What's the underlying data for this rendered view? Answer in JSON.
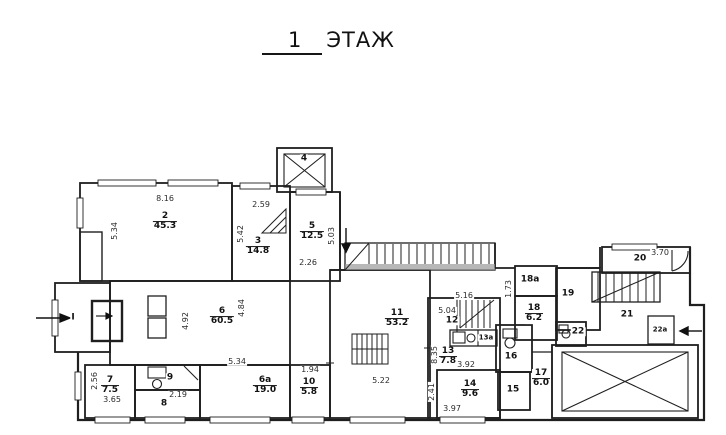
{
  "title": {
    "floor_number": "1",
    "floor_word": "ЭТАЖ"
  },
  "colors": {
    "background": "#ffffff",
    "line": "#1f1f1f",
    "dim_text": "#2b2b2b"
  },
  "plan": {
    "rooms": [
      {
        "num": "2",
        "area": "45.3",
        "x": 165,
        "y": 222
      },
      {
        "num": "3",
        "area": "14.8",
        "x": 258,
        "y": 247
      },
      {
        "num": "5",
        "area": "12.5",
        "x": 312,
        "y": 232
      },
      {
        "num": "6",
        "area": "60.5",
        "x": 222,
        "y": 317
      },
      {
        "num": "6а",
        "area": "19.0",
        "x": 265,
        "y": 386
      },
      {
        "num": "7",
        "area": "7.5",
        "x": 110,
        "y": 386
      },
      {
        "num": "10",
        "area": "5.8",
        "x": 309,
        "y": 388
      },
      {
        "num": "11",
        "area": "53.2",
        "x": 397,
        "y": 319
      },
      {
        "num": "13",
        "area": "7.8",
        "x": 448,
        "y": 357
      },
      {
        "num": "14",
        "area": "9.6",
        "x": 470,
        "y": 390
      },
      {
        "num": "17",
        "area": "6.0",
        "x": 541,
        "y": 379
      },
      {
        "num": "18",
        "area": "6.2",
        "x": 534,
        "y": 314
      }
    ],
    "labels": [
      {
        "text": "4",
        "x": 304,
        "y": 159
      },
      {
        "text": "8",
        "x": 164,
        "y": 404
      },
      {
        "text": "9",
        "x": 170,
        "y": 378
      },
      {
        "text": "12",
        "x": 452,
        "y": 321
      },
      {
        "text": "13а",
        "x": 486,
        "y": 338,
        "small": true
      },
      {
        "text": "15",
        "x": 513,
        "y": 390
      },
      {
        "text": "16",
        "x": 511,
        "y": 357
      },
      {
        "text": "19",
        "x": 568,
        "y": 294
      },
      {
        "text": "20",
        "x": 640,
        "y": 259
      },
      {
        "text": "21",
        "x": 627,
        "y": 315
      },
      {
        "text": "22",
        "x": 578,
        "y": 332
      },
      {
        "text": "22а",
        "x": 660,
        "y": 330,
        "small": true
      },
      {
        "text": "18а",
        "x": 530,
        "y": 280
      },
      {
        "text": "I",
        "x": 73,
        "y": 318
      }
    ],
    "dimensions": [
      {
        "text": "8.16",
        "x": 165,
        "y": 199
      },
      {
        "text": "2.59",
        "x": 261,
        "y": 205
      },
      {
        "text": "2.26",
        "x": 308,
        "y": 263
      },
      {
        "text": "5.34",
        "x": 115,
        "y": 231,
        "rot": 90
      },
      {
        "text": "5.42",
        "x": 241,
        "y": 234,
        "rot": 90
      },
      {
        "text": "5.03",
        "x": 332,
        "y": 236,
        "rot": 90
      },
      {
        "text": "4.92",
        "x": 186,
        "y": 321,
        "rot": 90
      },
      {
        "text": "4.84",
        "x": 242,
        "y": 308,
        "rot": 90
      },
      {
        "text": "5.34",
        "x": 237,
        "y": 362
      },
      {
        "text": "3.65",
        "x": 112,
        "y": 400
      },
      {
        "text": "2.56",
        "x": 95,
        "y": 381,
        "rot": 90
      },
      {
        "text": "2.19",
        "x": 178,
        "y": 395
      },
      {
        "text": "1.94",
        "x": 310,
        "y": 370
      },
      {
        "text": "5.22",
        "x": 381,
        "y": 381
      },
      {
        "text": "8.35",
        "x": 435,
        "y": 355,
        "rot": 90
      },
      {
        "text": "5.16",
        "x": 464,
        "y": 296
      },
      {
        "text": "5.04",
        "x": 447,
        "y": 311
      },
      {
        "text": "3.92",
        "x": 466,
        "y": 365
      },
      {
        "text": "2.41",
        "x": 432,
        "y": 392,
        "rot": 90
      },
      {
        "text": "3.97",
        "x": 452,
        "y": 409
      },
      {
        "text": "3.70",
        "x": 660,
        "y": 253
      },
      {
        "text": "1.73",
        "x": 509,
        "y": 289,
        "rot": 90
      }
    ]
  }
}
